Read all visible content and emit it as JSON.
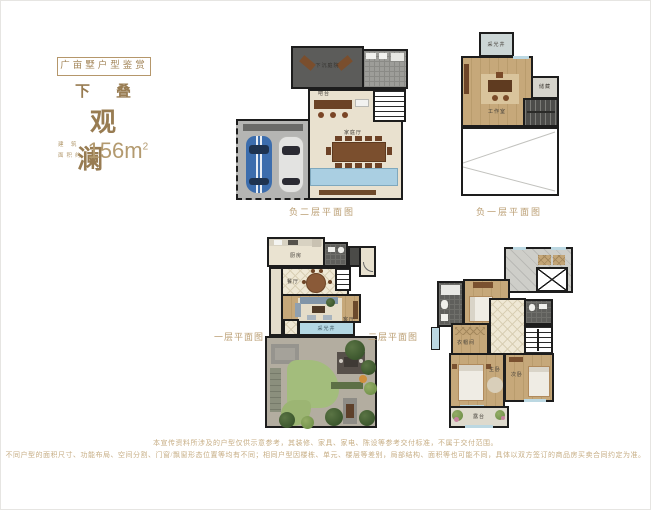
{
  "header": {
    "badge": "广亩墅户型鉴赏",
    "series": "下叠",
    "name": "观澜",
    "area_label_top": "建 筑",
    "area_label_bottom": "面积约",
    "area_value": "156m",
    "area_unit_sup": "2"
  },
  "plans": {
    "b2": {
      "caption": "负二层平面图",
      "rooms": {
        "sunken_courtyard": "下沉庭院",
        "bar": "吧台",
        "family_hall": "家庭厅"
      }
    },
    "b1": {
      "caption": "负一层平面图",
      "rooms": {
        "light_well": "采光井",
        "studio": "工作室",
        "storage": "储藏"
      }
    },
    "f1": {
      "caption": "一层平面图",
      "rooms": {
        "kitchen": "厨房",
        "dining": "餐厅",
        "living": "客厅",
        "light_well": "采光井"
      }
    },
    "f2": {
      "caption": "二层平面图",
      "rooms": {
        "bedroom": "卧室",
        "closet": "衣帽间",
        "master": "主卧",
        "second": "次卧",
        "terrace": "露台"
      }
    }
  },
  "disclaimer": {
    "line1": "本宣传资料所涉及的户型仅供示意参考，其装修、家具、家电、陈设等参考交付标准，不属于交付范围。",
    "line2": "不同户型的面积尺寸、功能布局、空间分割、门窗/飘窗形态位置等均有不同；相同户型因楼栋、单元、楼层等差别，局部结构、面积等也可能不同，具体以双方签订的商品房买卖合同约定为准。"
  },
  "colors": {
    "accent_gold": "#b3946b"
  }
}
